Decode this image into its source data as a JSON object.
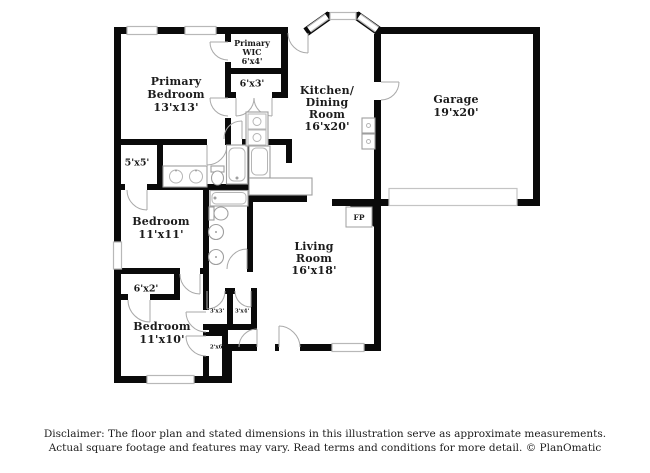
{
  "plan": {
    "fireplace_label": "FP",
    "disclaimer_line1": "Disclaimer: The floor plan and stated dimensions in this illustration serve as approximate measurements.",
    "disclaimer_line2": "Actual square footage and features may vary. Read terms and conditions for more detail. © PlanOmatic"
  },
  "rooms": {
    "primary_bedroom": {
      "lines": [
        "Primary",
        "Bedroom"
      ],
      "dims": "13'x13'"
    },
    "primary_wic": {
      "lines": [
        "Primary",
        "WIC"
      ],
      "dims": "6'x4'"
    },
    "primary_bath": {
      "dims": "6'x3'"
    },
    "kitchen_dining": {
      "lines": [
        "Kitchen/",
        "Dining",
        "Room"
      ],
      "dims": "16'x20'"
    },
    "garage": {
      "lines": [
        "Garage"
      ],
      "dims": "19'x20'"
    },
    "closet_5x5": {
      "dims": "5'x5'"
    },
    "bedroom_2": {
      "lines": [
        "Bedroom"
      ],
      "dims": "11'x11'"
    },
    "living_room": {
      "lines": [
        "Living",
        "Room"
      ],
      "dims": "16'x18'"
    },
    "closet_6x2": {
      "dims": "6'x2'"
    },
    "bedroom_3": {
      "lines": [
        "Bedroom"
      ],
      "dims": "11'x10'"
    },
    "closet_3x3": {
      "dims": "3'x3'"
    },
    "closet_3x4": {
      "dims": "3'x4'"
    },
    "closet_2x6": {
      "dims": "2'x6'"
    }
  },
  "colors": {
    "wall": "#0a0a0a",
    "window_stroke": "#b8b8b8",
    "fixture_stroke": "#9f9f9f",
    "text": "#1c1c1c"
  }
}
